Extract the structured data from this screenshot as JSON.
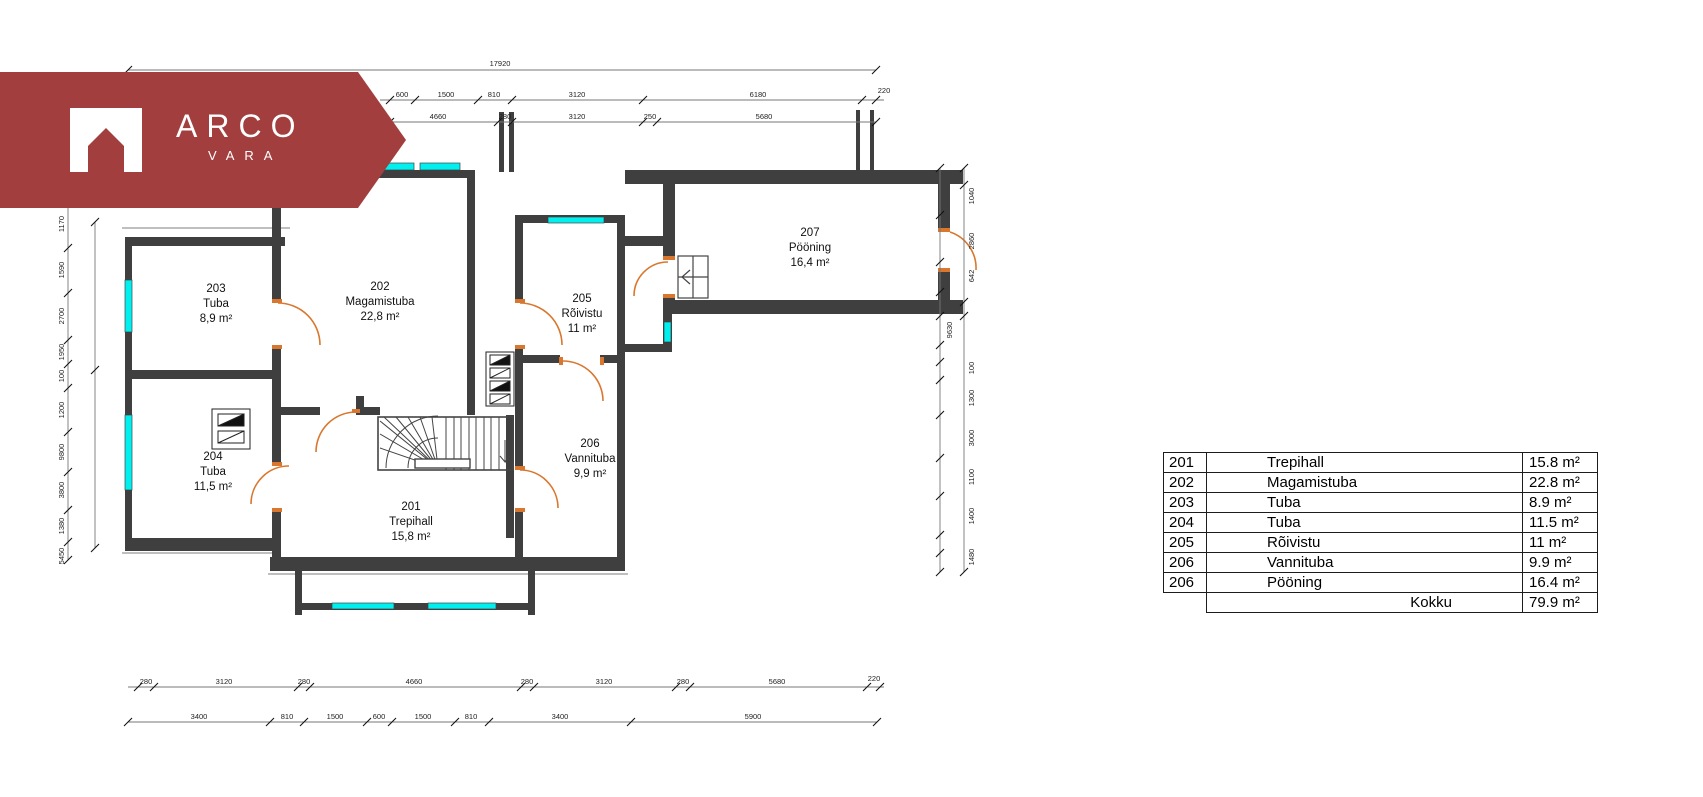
{
  "logo": {
    "brand": "ARCO",
    "sub": "VARA"
  },
  "colors": {
    "accent_red": "#A33E3E",
    "window_cyan": "#00EFEF",
    "door_orange": "#D9772E",
    "wall_gray": "#3f3f3f"
  },
  "plan": {
    "rooms": [
      {
        "number": "201",
        "name": "Trepihall",
        "area": "15,8 m²",
        "x": 411,
        "y": 500
      },
      {
        "number": "202",
        "name": "Magamistuba",
        "area": "22,8 m²",
        "x": 380,
        "y": 280
      },
      {
        "number": "203",
        "name": "Tuba",
        "area": "8,9 m²",
        "x": 216,
        "y": 282
      },
      {
        "number": "204",
        "name": "Tuba",
        "area": "11,5 m²",
        "x": 213,
        "y": 450
      },
      {
        "number": "205",
        "name": "Rõivistu",
        "area": "11 m²",
        "x": 582,
        "y": 292
      },
      {
        "number": "206",
        "name": "Vannituba",
        "area": "9,9 m²",
        "x": 590,
        "y": 437
      },
      {
        "number": "207",
        "name": "Pööning",
        "area": "16,4 m²",
        "x": 810,
        "y": 226
      }
    ],
    "dim_lines": [
      [
        128,
        70,
        876,
        70
      ],
      [
        380,
        100,
        884,
        100
      ],
      [
        380,
        122,
        876,
        122
      ],
      [
        128,
        687,
        884,
        687
      ],
      [
        128,
        722,
        877,
        722
      ],
      [
        68,
        200,
        68,
        560
      ],
      [
        95,
        222,
        95,
        548
      ],
      [
        940,
        168,
        940,
        572
      ],
      [
        964,
        168,
        964,
        572
      ]
    ],
    "ticks_h": [
      {
        "y": 70,
        "xs": [
          128,
          876
        ]
      },
      {
        "y": 100,
        "xs": [
          390,
          415,
          478,
          512,
          643,
          862,
          876
        ]
      },
      {
        "y": 122,
        "xs": [
          390,
          498,
          512,
          643,
          657,
          876
        ]
      },
      {
        "y": 687,
        "xs": [
          138,
          154,
          298,
          310,
          521,
          534,
          676,
          690,
          867,
          880
        ]
      },
      {
        "y": 722,
        "xs": [
          128,
          270,
          304,
          367,
          392,
          455,
          489,
          631,
          877
        ]
      }
    ],
    "ticks_v": [
      {
        "x": 68,
        "ys": [
          200,
          248,
          293,
          340,
          364,
          388,
          432,
          472,
          510,
          542,
          560
        ]
      },
      {
        "x": 95,
        "ys": [
          222,
          370,
          548
        ]
      },
      {
        "x": 940,
        "ys": [
          168,
          215,
          262,
          292,
          316,
          345,
          362,
          380,
          415,
          458,
          496,
          535,
          553,
          572
        ]
      },
      {
        "x": 964,
        "ys": [
          168,
          185,
          302,
          316,
          572
        ]
      }
    ],
    "labels": [
      {
        "t": "17920",
        "x": 500,
        "y": 66
      },
      {
        "t": "600",
        "x": 402,
        "y": 97
      },
      {
        "t": "1500",
        "x": 446,
        "y": 97
      },
      {
        "t": "810",
        "x": 494,
        "y": 97
      },
      {
        "t": "3120",
        "x": 577,
        "y": 97
      },
      {
        "t": "6180",
        "x": 758,
        "y": 97
      },
      {
        "t": "220",
        "x": 884,
        "y": 93
      },
      {
        "t": "4660",
        "x": 438,
        "y": 119
      },
      {
        "t": "280",
        "x": 505,
        "y": 119
      },
      {
        "t": "3120",
        "x": 577,
        "y": 119
      },
      {
        "t": "250",
        "x": 650,
        "y": 119
      },
      {
        "t": "5680",
        "x": 764,
        "y": 119
      },
      {
        "t": "280",
        "x": 146,
        "y": 684
      },
      {
        "t": "3120",
        "x": 224,
        "y": 684
      },
      {
        "t": "280",
        "x": 304,
        "y": 684
      },
      {
        "t": "4660",
        "x": 414,
        "y": 684
      },
      {
        "t": "280",
        "x": 527,
        "y": 684
      },
      {
        "t": "3120",
        "x": 604,
        "y": 684
      },
      {
        "t": "280",
        "x": 683,
        "y": 684
      },
      {
        "t": "5680",
        "x": 777,
        "y": 684
      },
      {
        "t": "220",
        "x": 874,
        "y": 681
      },
      {
        "t": "3400",
        "x": 199,
        "y": 719
      },
      {
        "t": "810",
        "x": 287,
        "y": 719
      },
      {
        "t": "1500",
        "x": 335,
        "y": 719
      },
      {
        "t": "600",
        "x": 379,
        "y": 719
      },
      {
        "t": "1500",
        "x": 423,
        "y": 719
      },
      {
        "t": "810",
        "x": 471,
        "y": 719
      },
      {
        "t": "3400",
        "x": 560,
        "y": 719
      },
      {
        "t": "5900",
        "x": 753,
        "y": 719
      },
      {
        "t": "1170",
        "x": 64,
        "y": 224,
        "r": 1
      },
      {
        "t": "1590",
        "x": 64,
        "y": 270,
        "r": 1
      },
      {
        "t": "2700",
        "x": 64,
        "y": 316,
        "r": 1
      },
      {
        "t": "1950",
        "x": 64,
        "y": 352,
        "r": 1
      },
      {
        "t": "100",
        "x": 64,
        "y": 376,
        "r": 1
      },
      {
        "t": "1200",
        "x": 64,
        "y": 410,
        "r": 1
      },
      {
        "t": "9800",
        "x": 64,
        "y": 452,
        "r": 1
      },
      {
        "t": "3800",
        "x": 64,
        "y": 490,
        "r": 1
      },
      {
        "t": "1380",
        "x": 64,
        "y": 526,
        "r": 1
      },
      {
        "t": "5450",
        "x": 64,
        "y": 556,
        "r": 1
      },
      {
        "t": "1040",
        "x": 974,
        "y": 196,
        "r": 1
      },
      {
        "t": "2860",
        "x": 974,
        "y": 241,
        "r": 1
      },
      {
        "t": "642",
        "x": 974,
        "y": 276,
        "r": 1
      },
      {
        "t": "9630",
        "x": 952,
        "y": 330,
        "r": 1
      },
      {
        "t": "100",
        "x": 974,
        "y": 368,
        "r": 1
      },
      {
        "t": "1300",
        "x": 974,
        "y": 398,
        "r": 1
      },
      {
        "t": "3000",
        "x": 974,
        "y": 438,
        "r": 1
      },
      {
        "t": "1100",
        "x": 974,
        "y": 477,
        "r": 1
      },
      {
        "t": "1400",
        "x": 974,
        "y": 516,
        "r": 1
      },
      {
        "t": "1480",
        "x": 974,
        "y": 557,
        "r": 1
      }
    ]
  },
  "table": {
    "rows": [
      {
        "num": "201",
        "name": "Trepihall",
        "area": "15.8 m²"
      },
      {
        "num": "202",
        "name": "Magamistuba",
        "area": "22.8 m²"
      },
      {
        "num": "203",
        "name": "Tuba",
        "area": "8.9 m²"
      },
      {
        "num": "204",
        "name": "Tuba",
        "area": "11.5 m²"
      },
      {
        "num": "205",
        "name": "Rõivistu",
        "area": "11 m²"
      },
      {
        "num": "206",
        "name": "Vannituba",
        "area": "9.9 m²"
      },
      {
        "num": "206",
        "name": "Pööning",
        "area": "16.4 m²"
      }
    ],
    "total_label": "Kokku",
    "total_area": "79.9 m²"
  }
}
